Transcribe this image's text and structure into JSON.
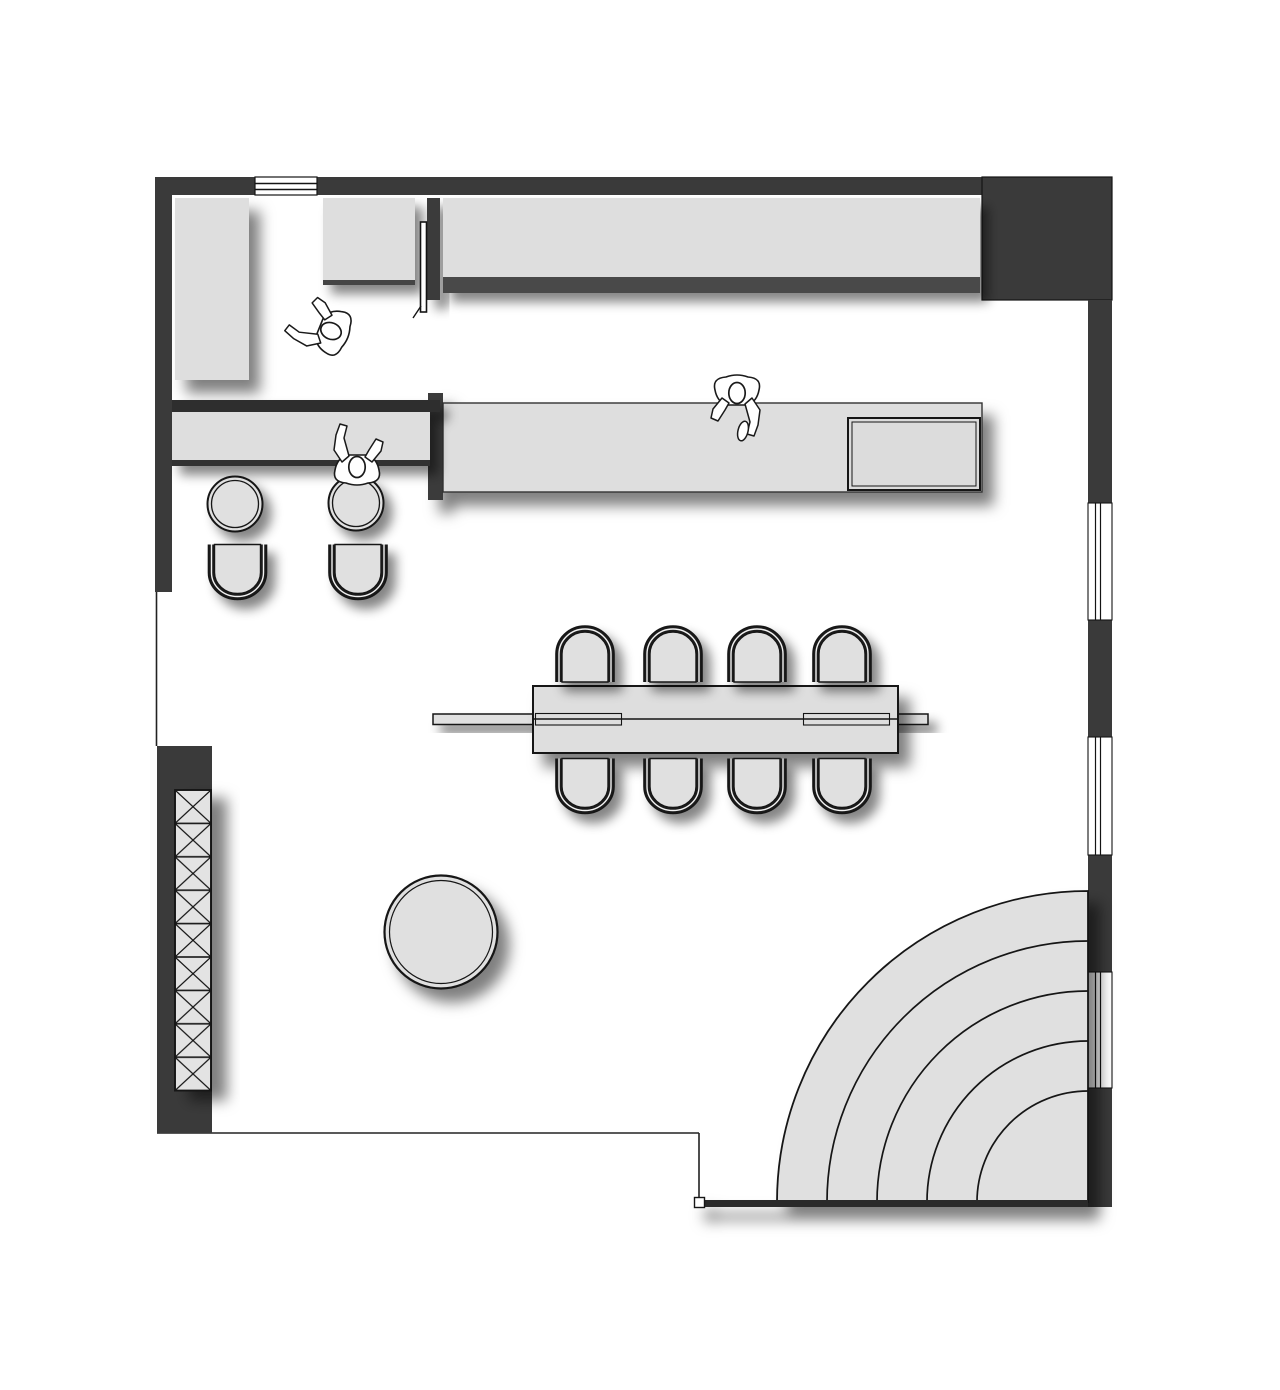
{
  "meta": {
    "type": "architectural-floor-plan",
    "view": "top-down plan drawing",
    "visible_text": "",
    "style": "black-and-white CAD plan with soft drop shadows"
  },
  "colors": {
    "background": "#ffffff",
    "wall": "#3a3a3a",
    "wall_dark_band": "#4a4a4a",
    "furniture_fill": "#e0e0e0",
    "counter_fill": "#dedede",
    "outline": "#141414",
    "shadow": "rgba(0,0,0,0.5)"
  },
  "inventory": {
    "perimeter": [
      "top-wall",
      "left-wall",
      "top-right-wall-block",
      "right-wall",
      "bottom-left-wall-block"
    ],
    "openings": {
      "top_vent_window": 1,
      "right_wall_windows": 3,
      "door_leaf": 1
    },
    "furniture": {
      "tall_cabinet_top_left": 1,
      "upper_cabinet": 1,
      "upper_wall_counter": 1,
      "island_counter": 1,
      "island_inset_appliance": 1,
      "left_bar_counter": 1,
      "bar_stools": 2,
      "lounge_chairs": 2,
      "communal_table": 1,
      "table_rail_bench": 1,
      "dining_chairs": 8,
      "round_table": 1,
      "tiered_quarter_circle_steps": 5,
      "hatched_shelf_cells": 9
    },
    "people": 3
  }
}
